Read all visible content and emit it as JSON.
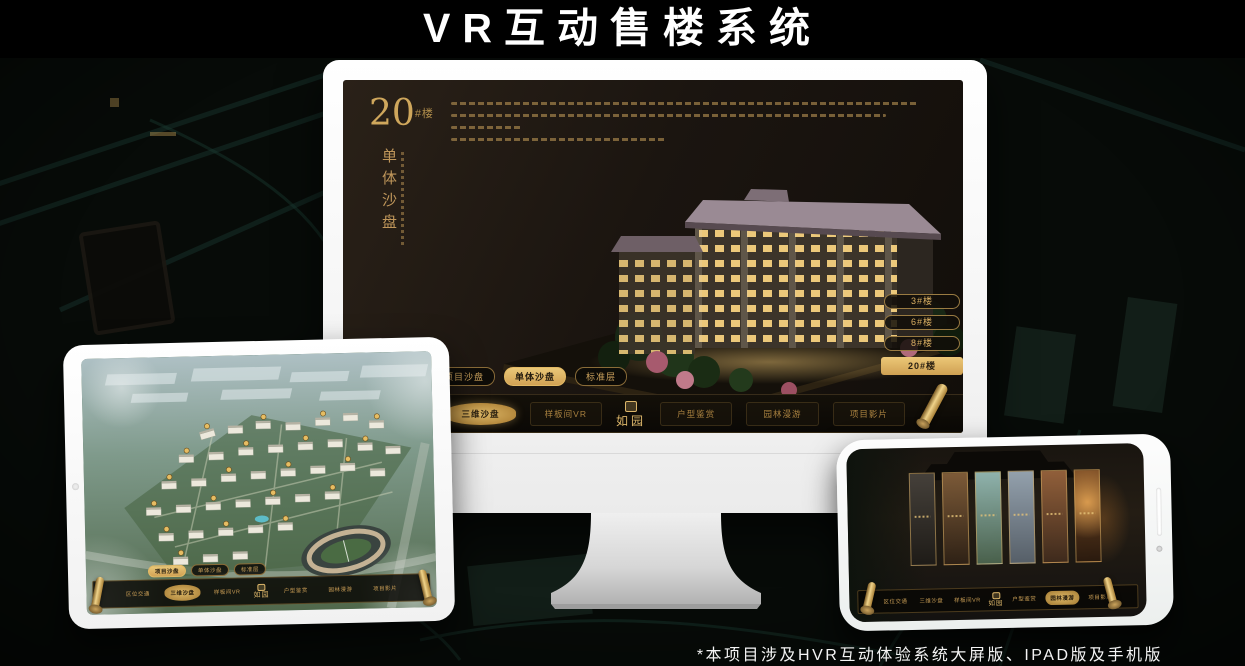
{
  "page": {
    "title": "VR互动售楼系统",
    "footnote": "*本项目涉及HVR互动体验系统大屏版、IPAD版及手机版"
  },
  "colors": {
    "gold": "#c9a257",
    "gold_bright": "#eac878",
    "screen_bg": "#1b1510",
    "bar_bg": "#0a0805",
    "frame_white": "#ffffff"
  },
  "desktop": {
    "heading": {
      "number": "20",
      "suffix": "#楼",
      "subtitle": "单体沙盘"
    },
    "tabs": [
      "项目沙盘",
      "单体沙盘",
      "标准层"
    ],
    "active_tab": "单体沙盘",
    "buildings": [
      "3#楼",
      "6#楼",
      "8#楼",
      "20#楼"
    ],
    "active_building": "20#楼",
    "nav": {
      "items": [
        "区位交通",
        "三维沙盘",
        "样板间VR",
        "户型鉴赏",
        "园林漫游",
        "项目影片"
      ],
      "logo": "如园",
      "active_item": "三维沙盘"
    }
  },
  "tablet": {
    "tabs": [
      "项目沙盘",
      "单体沙盘",
      "标准层"
    ],
    "active_tab": "项目沙盘",
    "nav": {
      "items": [
        "区位交通",
        "三维沙盘",
        "样板间VR",
        "户型鉴赏",
        "园林漫游",
        "项目影片"
      ],
      "logo": "如园",
      "active_item": "三维沙盘"
    }
  },
  "phone": {
    "nav": {
      "items": [
        "区位交通",
        "三维沙盘",
        "样板间VR",
        "户型鉴赏",
        "园林漫游",
        "项目影片"
      ],
      "logo": "如园",
      "active_item": "园林漫游"
    }
  }
}
